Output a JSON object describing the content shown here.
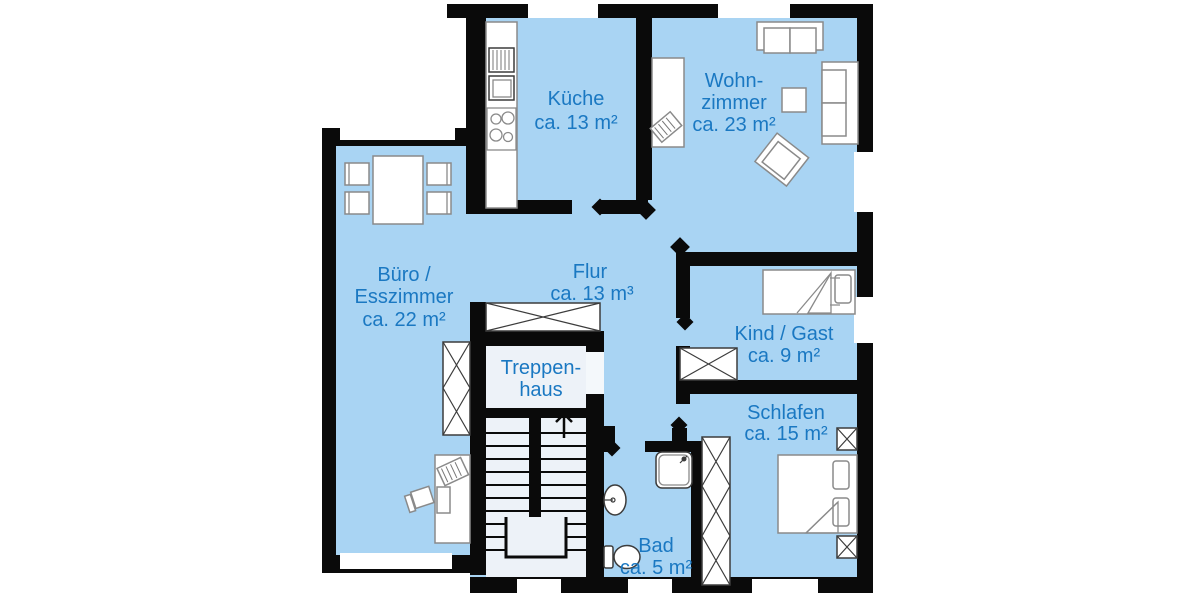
{
  "colors": {
    "background": "#ffffff",
    "wall": "#0a0a0a",
    "room_fill": "#a9d4f3",
    "stairwell_fill": "#edf2f8",
    "label_text": "#1a78c2",
    "furniture_fill": "#ffffff",
    "furniture_stroke": "#8a8a8a",
    "furniture_dark_stroke": "#3c3c3c"
  },
  "rooms": {
    "kueche": {
      "name": "Küche",
      "area": "ca. 13 m²"
    },
    "wohnzimmer": {
      "name_line1": "Wohn-",
      "name_line2": "zimmer",
      "area": "ca. 23 m²"
    },
    "buero_esszimmer": {
      "name_line1": "Büro /",
      "name_line2": "Esszimmer",
      "area": "ca. 22 m²"
    },
    "flur": {
      "name": "Flur",
      "area": "ca. 13 m³"
    },
    "treppenhaus": {
      "name_line1": "Treppen-",
      "name_line2": "haus"
    },
    "kind_gast": {
      "name": "Kind / Gast",
      "area": "ca. 9 m²"
    },
    "schlafen": {
      "name": "Schlafen",
      "area": "ca. 15 m²"
    },
    "bad": {
      "name": "Bad",
      "area": "ca. 5 m²"
    }
  }
}
